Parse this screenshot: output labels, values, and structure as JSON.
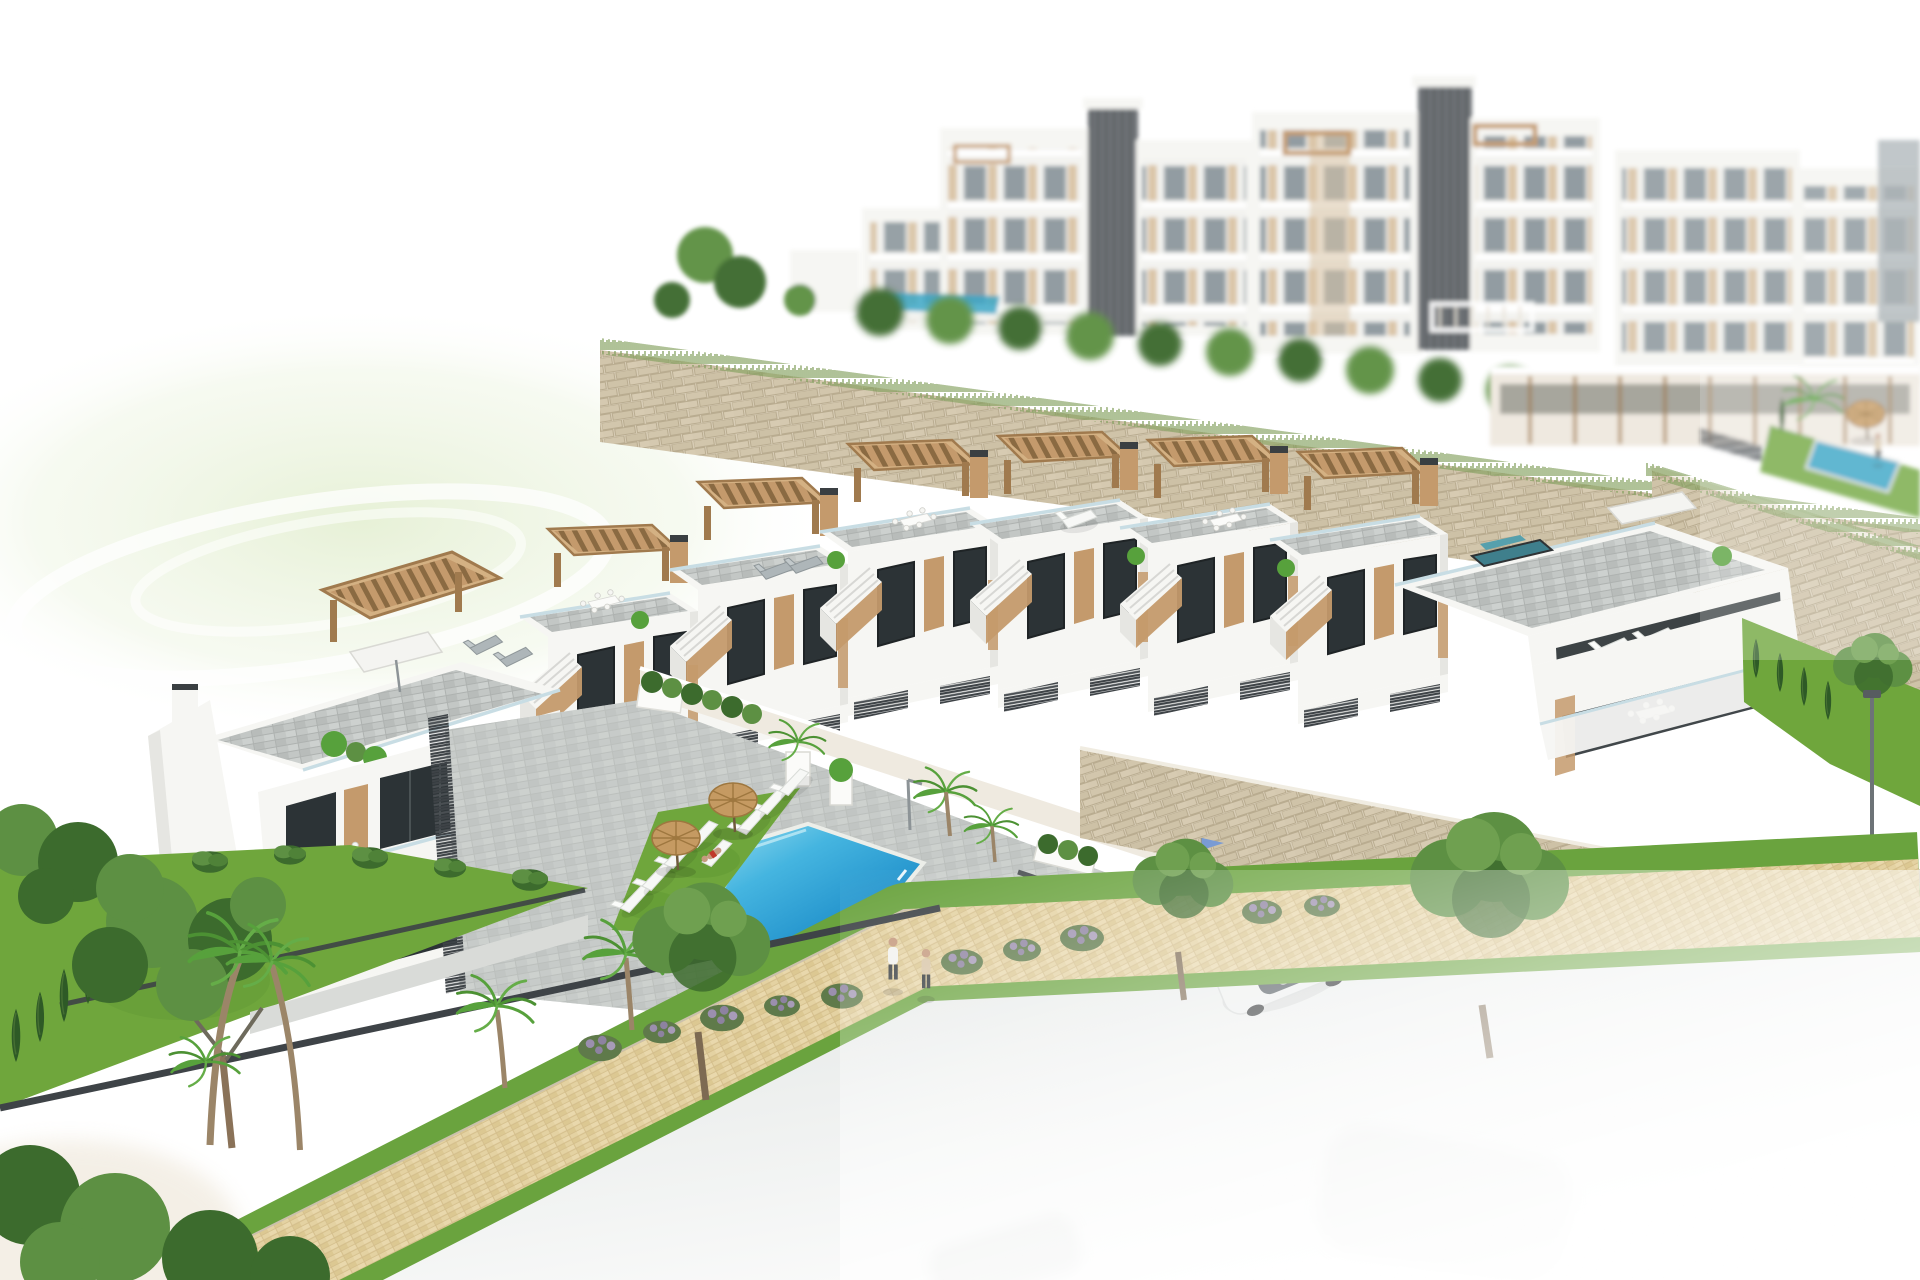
{
  "scene": {
    "title": "Aerial 3D render of a hillside residential development",
    "description": "Photorealistic architect's render: a diagonal row of white Mediterranean townhouses with grey roof terraces, timber pergolas and external stairs sits above a communal courtyard with a bright blue pool, lawn strip with white sun loungers and two straw parasols. A matching duplex stands to the left. Behind, beige stone retaining walls climb to large white apartment blocks with dark lift shafts. Bottom-left: vivid gardens with palms, cypresses and a pine. A sand-coloured tiled footpath with grass verges runs diagonally; a couple walks on it. Bottom-right: a grey road with a white sedan and a silver car by a garage driveway, everything fading into white haze.",
    "regions": [
      {
        "id": "background-apartments",
        "label": "white apartment towers with lift shafts and balconies"
      },
      {
        "id": "stone-retaining-walls",
        "label": "beige dry-stone retaining walls with grass fringe"
      },
      {
        "id": "townhouse-row",
        "label": "row of white townhouses with pergolas, roof terraces and stairs"
      },
      {
        "id": "left-duplex",
        "label": "two-unit white duplex with chimney, pergolas and terraces"
      },
      {
        "id": "communal-pool",
        "label": "blue swimming pool with paved surround"
      },
      {
        "id": "pool-lawn",
        "label": "lawn strip with sun loungers and straw parasols"
      },
      {
        "id": "gardens",
        "label": "gardens with palms, cypresses, pine and flowering shrubs"
      },
      {
        "id": "footpath",
        "label": "sand-coloured tiled footpath with grass verges"
      },
      {
        "id": "road",
        "label": "grey road fading to white with parked cars"
      },
      {
        "id": "people",
        "label": "couple walking on the footpath, sunbather, swimmer"
      }
    ],
    "counts": {
      "townhouse_units": 5,
      "poolside_loungers": 8,
      "poolside_parasols": 2,
      "background_towers": 6,
      "cars_visible": 2,
      "pedestrians": 2
    }
  },
  "palette": {
    "white_wall": "#f6f6f3",
    "wall_shade": "#e6e6e2",
    "wall_dark": "#d4d5d2",
    "stucco": "#efeae0",
    "window_dark": "#2c3336",
    "wood": "#c49a6c",
    "wood_dark": "#a07a4e",
    "wood_light": "#d4b183",
    "fence_dark": "#3e4347",
    "glass_rail": "#c8dde4",
    "stone_base": "#d8cdb6",
    "stone_line": "#b9ac90",
    "paver": "#c3c7c5",
    "paver_line": "#aeb2b0",
    "lawn": "#6fa63c",
    "lawn_dark": "#578f2e",
    "leaf": "#5d9043",
    "leaf_dark": "#3c6b2d",
    "cypress": "#2e5a26",
    "palm": "#57a13c",
    "flower_bush": "#8d82a0",
    "pool_light": "#9fe0f0",
    "pool_main": "#2aa4da",
    "pool_deep": "#1779b4",
    "pool_teal": "#35a3c4",
    "path_tile": "#e4d2a2",
    "path_grout": "#d3bd8a",
    "kerb": "#cbc1ab",
    "road": "#e0e3e2",
    "metal": "#7c8386",
    "shaft": "#5d6266",
    "balcony_beige": "#d9c3a4",
    "bg_window": "#8e999f",
    "umbrella": "#c59a62",
    "umbrella_rib": "#9e773f",
    "skin": "#c59a7e",
    "swimsuit_red": "#c0392b",
    "car_white": "#eef0ef",
    "car_silver": "#b4b1b6",
    "car_glass": "#434c52",
    "flag_blue": "#7a9bd4",
    "hill": "#e4efd2",
    "haze": "#ffffff"
  }
}
